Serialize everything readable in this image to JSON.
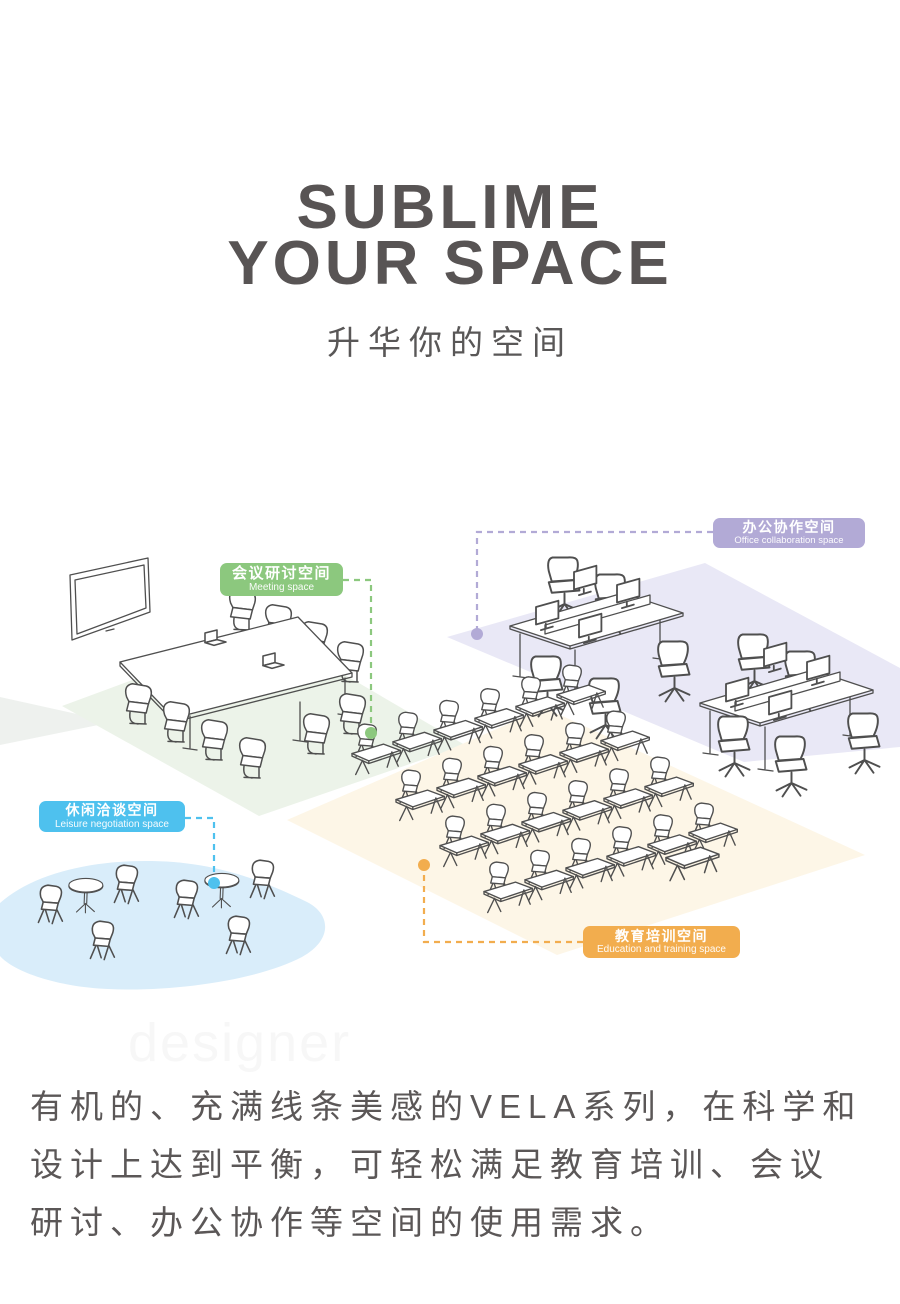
{
  "header": {
    "title_line1": "SUBLIME",
    "title_line2": "YOUR SPACE",
    "subtitle": "升华你的空间",
    "title_color": "#585454"
  },
  "diagram": {
    "labels": {
      "meeting": {
        "zh": "会议研讨空间",
        "en": "Meeting space",
        "color": "#8cc87e"
      },
      "office": {
        "zh": "办公协作空间",
        "en": "Office collaboration space",
        "color": "#b2aad6"
      },
      "leisure": {
        "zh": "休闲洽谈空间",
        "en": "Leisure negotiation space",
        "color": "#4ec1ee"
      },
      "education": {
        "zh": "教育培训空间",
        "en": "Education and training space",
        "color": "#f2ad4e"
      }
    },
    "floor_colors": {
      "meeting": "#ecf3e9",
      "office": "#e9e8f6",
      "leisure": "#d9edfa",
      "education": "#fdf6e7",
      "side_patch": "#eef1ee"
    },
    "line_color": "#4f4f4f"
  },
  "watermark": "designer",
  "body_text": {
    "lines": [
      "有机的、充满线条美感的VELA系列，在科学和",
      "设计上达到平衡，可轻松满足教育培训、会议",
      "研讨、办公协作等空间的使用需求。"
    ],
    "color": "#5b5757"
  }
}
